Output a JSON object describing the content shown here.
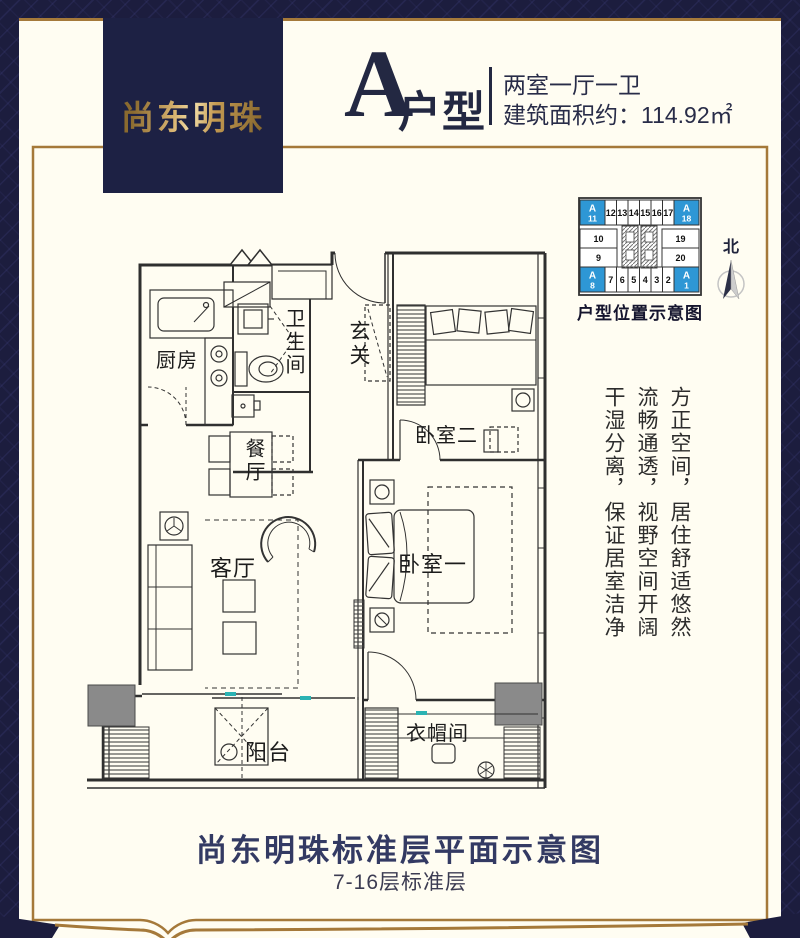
{
  "header": {
    "badge": "尚东明珠",
    "unit_letter": "A",
    "unit_type_label": "户型",
    "layout_spec": "两室一厅一卫",
    "area_spec": "建筑面积约：114.92㎡"
  },
  "location_diagram": {
    "caption": "户型位置示意图",
    "north_label": "北",
    "rows": {
      "top": [
        "A/11",
        "12",
        "13",
        "14",
        "15",
        "16",
        "17",
        "A/18"
      ],
      "left": [
        "10",
        "9"
      ],
      "right": [
        "19",
        "20"
      ],
      "bottom": [
        "A/8",
        "7",
        "6",
        "5",
        "4",
        "3",
        "2",
        "A/1"
      ]
    }
  },
  "floor_plan": {
    "rooms": {
      "kitchen": "厨房",
      "bathroom": "卫生间",
      "hallway": "玄关",
      "bedroom2": "卧室二",
      "dining": "餐厅",
      "living": "客厅",
      "bedroom1": "卧室一",
      "balcony": "阳台",
      "cloakroom": "衣帽间"
    }
  },
  "slogans": [
    "方正空间，居住舒适悠然",
    "流畅通透，视野空间开阔",
    "干湿分离，保证居室洁净"
  ],
  "footer": {
    "title": "尚东明珠标准层平面示意图",
    "subtitle": "7-16层标准层"
  },
  "colors": {
    "navy": "#1c1d3e",
    "badge_navy": "#1d2144",
    "cream": "#fffdf2",
    "gold": "#a5793a",
    "gold_text": "#c9a35c",
    "unit_blue": "#2e97d5",
    "teal": "#2bb3b3",
    "pillar_gray": "#8a8a8a"
  }
}
